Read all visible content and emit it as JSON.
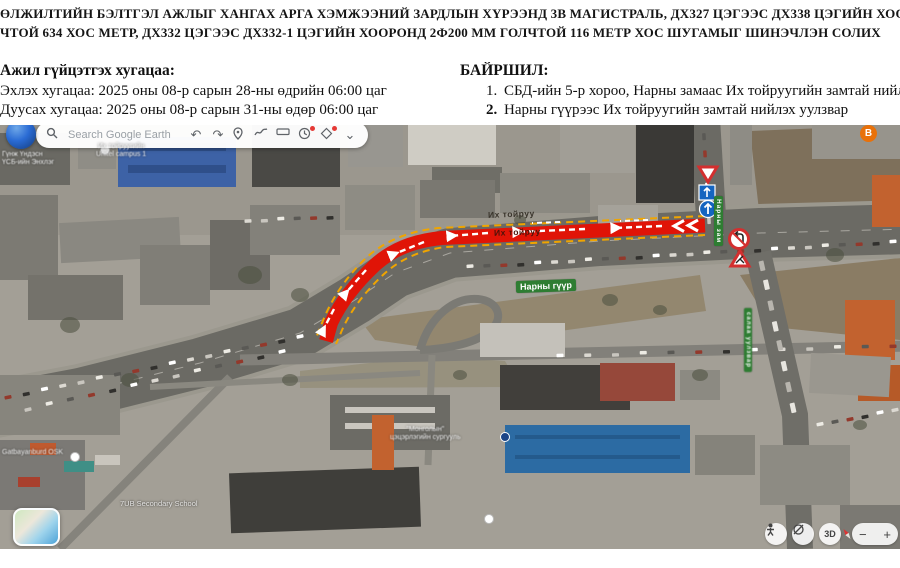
{
  "header": {
    "line1": "ӨЛЖИЛТИЙН БЭЛТГЭЛ АЖЛЫГ ХАНГАХ АРГА ХЭМЖЭЭНИЙ ЗАРДЛЫН ХҮРЭЭНД 3В МАГИСТРАЛЬ, ДХ327 ЦЭГЭЭС ДХ338 ЦЭГИЙН ХООРОНД 2Ф500 М",
    "line2": "ЧТОЙ 634 ХОС МЕТР, ДХ332 ЦЭГЭЭС ДХ332-1 ЦЭГИЙН ХООРОНД 2Ф200 ММ ГОЛЧТОЙ 116 МЕТР ХОС ШУГАМЫГ ШИНЭЧЛЭН СОЛИХ"
  },
  "schedule": {
    "title": "Ажил гүйцэтгэх хугацаа:",
    "items": [
      "Эхлэх хугацаа: 2025 оны 08-р сарын 28-ны өдрийн 06:00 цаг",
      "Дуусах хугацаа: 2025 оны 08-р сарын 31-ны өдөр 06:00 цаг"
    ]
  },
  "location": {
    "title": "БАЙРШИЛ:",
    "items": [
      {
        "num": "1.",
        "text": "СБД-ийн 5-р хороо, Нарны замаас Их тойруугийн замтай нийлэх туслах за"
      },
      {
        "num": "2.",
        "text": "Нарны гүүрээс Их тойруугийн замтай нийлэх уулзвар"
      }
    ]
  },
  "earth": {
    "search_placeholder": "Search Google Earth",
    "undo_glyph": "↶",
    "redo_glyph": "↷",
    "chevron_glyph": "⌄",
    "badge": "B",
    "view_3d": "3D",
    "zoom_out": "−",
    "zoom_in": "+",
    "icons": [
      "search-icon",
      "undo-icon",
      "redo-icon",
      "placemark-icon",
      "path-icon",
      "measure-icon",
      "history-icon",
      "snapshot-icon",
      "chevron-down-icon",
      "pegman-icon",
      "orbit-icon",
      "compass-icon",
      "layers-thumbnail"
    ]
  },
  "labels": {
    "narny_guur": "Нарны гүүр",
    "ikh_toiruu_a": "Их тойруу",
    "ikh_toiruu_b": "Их тойруу",
    "narny_zam": "Нарны зам",
    "uulzvar": "салаа уулзвар",
    "poi_top_1": "Гүнж Үндэсн",
    "poi_top_2": "ҮСБ-ийн Энхлэг",
    "campus_1": "Их тойруугийн",
    "campus_2": "Unitel campus 1",
    "osk": "Gatbayanburd OSK",
    "school": "7UB Secondary School",
    "kinder_1": "\"Монголын\"",
    "kinder_2": "цэцэрлэгийн сургууль"
  },
  "colors": {
    "route_red": "#e01407",
    "route_outline_yellow": "#f0a500",
    "arrow_white": "#ffffff",
    "label_green": "#2e7d32",
    "sign_red": "#d32f2f",
    "sign_blue": "#1565c0",
    "badge_orange": "#e8710a"
  }
}
